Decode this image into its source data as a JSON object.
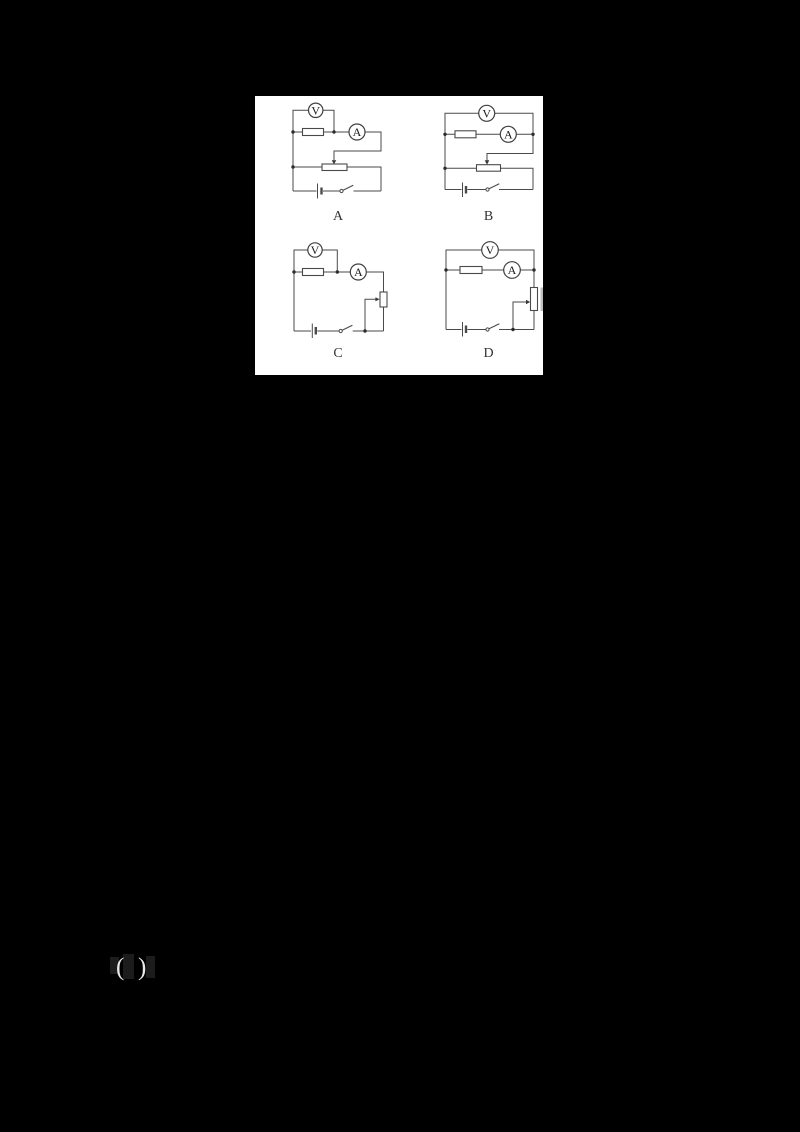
{
  "page": {
    "background_color": "#000000"
  },
  "figure": {
    "panel_background": "#ffffff",
    "wire_color": "#4a4a4a",
    "circuits": [
      {
        "label": "A",
        "voltmeter_label": "V",
        "ammeter_label": "A"
      },
      {
        "label": "B",
        "voltmeter_label": "V",
        "ammeter_label": "A"
      },
      {
        "label": "C",
        "voltmeter_label": "V",
        "ammeter_label": "A"
      },
      {
        "label": "D",
        "voltmeter_label": "V",
        "ammeter_label": "A"
      }
    ]
  },
  "answer_blank": {
    "open_paren": "(",
    "close_paren": ")"
  }
}
